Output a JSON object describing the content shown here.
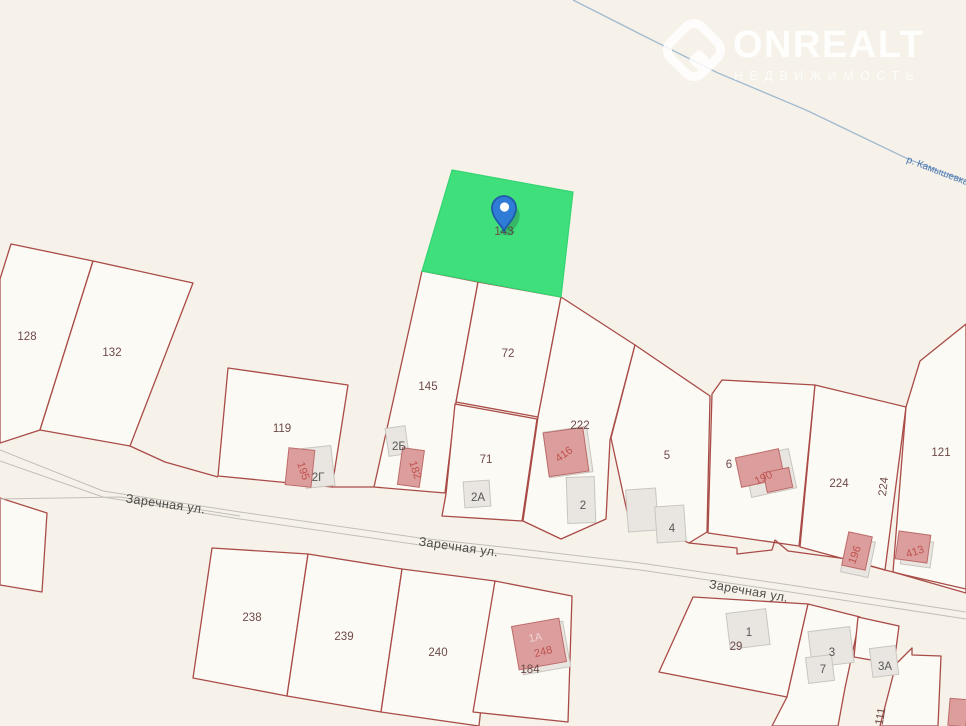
{
  "app": {
    "description": "cadastral parcel map with selected lot and marker"
  },
  "watermark": {
    "title": "ONREALT",
    "subtitle": "НЕДВИЖИМОСТЬ"
  },
  "selected_parcel": {
    "label": "143"
  },
  "river": {
    "label": "р. Камышевка"
  },
  "colors": {
    "background": "#f6f2ea",
    "parcel_fill": "#fcfaf4",
    "boundary_red": "#a94b47",
    "selected_green": "#3fdf7c",
    "selected_green_stroke": "#34d473",
    "pin_blue": "#2e7cd6",
    "pin_stroke": "#1f5aa8",
    "road_gray": "#c2bfb8",
    "river_blue": "#a3bbd1"
  },
  "labels": [
    {
      "t": "128",
      "x": 27,
      "y": 340,
      "c": "parcel"
    },
    {
      "t": "132",
      "x": 112,
      "y": 356,
      "c": "parcel"
    },
    {
      "t": "119",
      "x": 282,
      "y": 432,
      "c": "parcel"
    },
    {
      "t": "145",
      "x": 428,
      "y": 390,
      "c": "parcel"
    },
    {
      "t": "72",
      "x": 508,
      "y": 357,
      "c": "parcel"
    },
    {
      "t": "71",
      "x": 486,
      "y": 463,
      "c": "parcel"
    },
    {
      "t": "222",
      "x": 580,
      "y": 429,
      "c": "parcel"
    },
    {
      "t": "5",
      "x": 667,
      "y": 459,
      "c": "parcel"
    },
    {
      "t": "6",
      "x": 729,
      "y": 468,
      "c": "parcel"
    },
    {
      "t": "224",
      "x": 839,
      "y": 487,
      "c": "parcel"
    },
    {
      "t": "224",
      "x": 887,
      "y": 487,
      "c": "parcel",
      "rot": -83
    },
    {
      "t": "121",
      "x": 941,
      "y": 456,
      "c": "parcel"
    },
    {
      "t": "238",
      "x": 252,
      "y": 621,
      "c": "parcel"
    },
    {
      "t": "239",
      "x": 344,
      "y": 640,
      "c": "parcel"
    },
    {
      "t": "240",
      "x": 438,
      "y": 656,
      "c": "parcel"
    },
    {
      "t": "184",
      "x": 530,
      "y": 673,
      "c": "parcel"
    },
    {
      "t": "29",
      "x": 736,
      "y": 650,
      "c": "parcel"
    },
    {
      "t": "111",
      "x": 884,
      "y": 717,
      "c": "parcel",
      "rot": -80
    },
    {
      "t": "143",
      "x": 504,
      "y": 235,
      "c": "parcel"
    },
    {
      "t": "2Г",
      "x": 318,
      "y": 481,
      "c": "house"
    },
    {
      "t": "2Б",
      "x": 399,
      "y": 450,
      "c": "house"
    },
    {
      "t": "2А",
      "x": 478,
      "y": 501,
      "c": "house"
    },
    {
      "t": "2",
      "x": 583,
      "y": 509,
      "c": "house"
    },
    {
      "t": "4",
      "x": 672,
      "y": 532,
      "c": "house"
    },
    {
      "t": "1",
      "x": 749,
      "y": 636,
      "c": "house"
    },
    {
      "t": "3",
      "x": 832,
      "y": 656,
      "c": "house"
    },
    {
      "t": "7",
      "x": 823,
      "y": 673,
      "c": "house"
    },
    {
      "t": "3А",
      "x": 885,
      "y": 670,
      "c": "house"
    },
    {
      "t": "195",
      "x": 300,
      "y": 472,
      "c": "housered",
      "rot": 72
    },
    {
      "t": "182",
      "x": 412,
      "y": 471,
      "c": "housered",
      "rot": 72
    },
    {
      "t": "416",
      "x": 566,
      "y": 457,
      "c": "housered",
      "rot": -36
    },
    {
      "t": "190",
      "x": 765,
      "y": 481,
      "c": "housered",
      "rot": -26
    },
    {
      "t": "196",
      "x": 858,
      "y": 556,
      "c": "housered",
      "rot": -70
    },
    {
      "t": "413",
      "x": 916,
      "y": 555,
      "c": "housered",
      "rot": -18
    },
    {
      "t": "248",
      "x": 544,
      "y": 655,
      "c": "housered",
      "rot": -14
    },
    {
      "t": "1А",
      "x": 536,
      "y": 641,
      "c": "pink",
      "rot": -10
    },
    {
      "t": "Заречная ул.",
      "x": 165,
      "y": 508,
      "c": "street",
      "rot": 8
    },
    {
      "t": "Заречная ул.",
      "x": 458,
      "y": 551,
      "c": "street",
      "rot": 8
    },
    {
      "t": "Заречная ул.",
      "x": 748,
      "y": 595,
      "c": "street",
      "rot": 10
    }
  ]
}
